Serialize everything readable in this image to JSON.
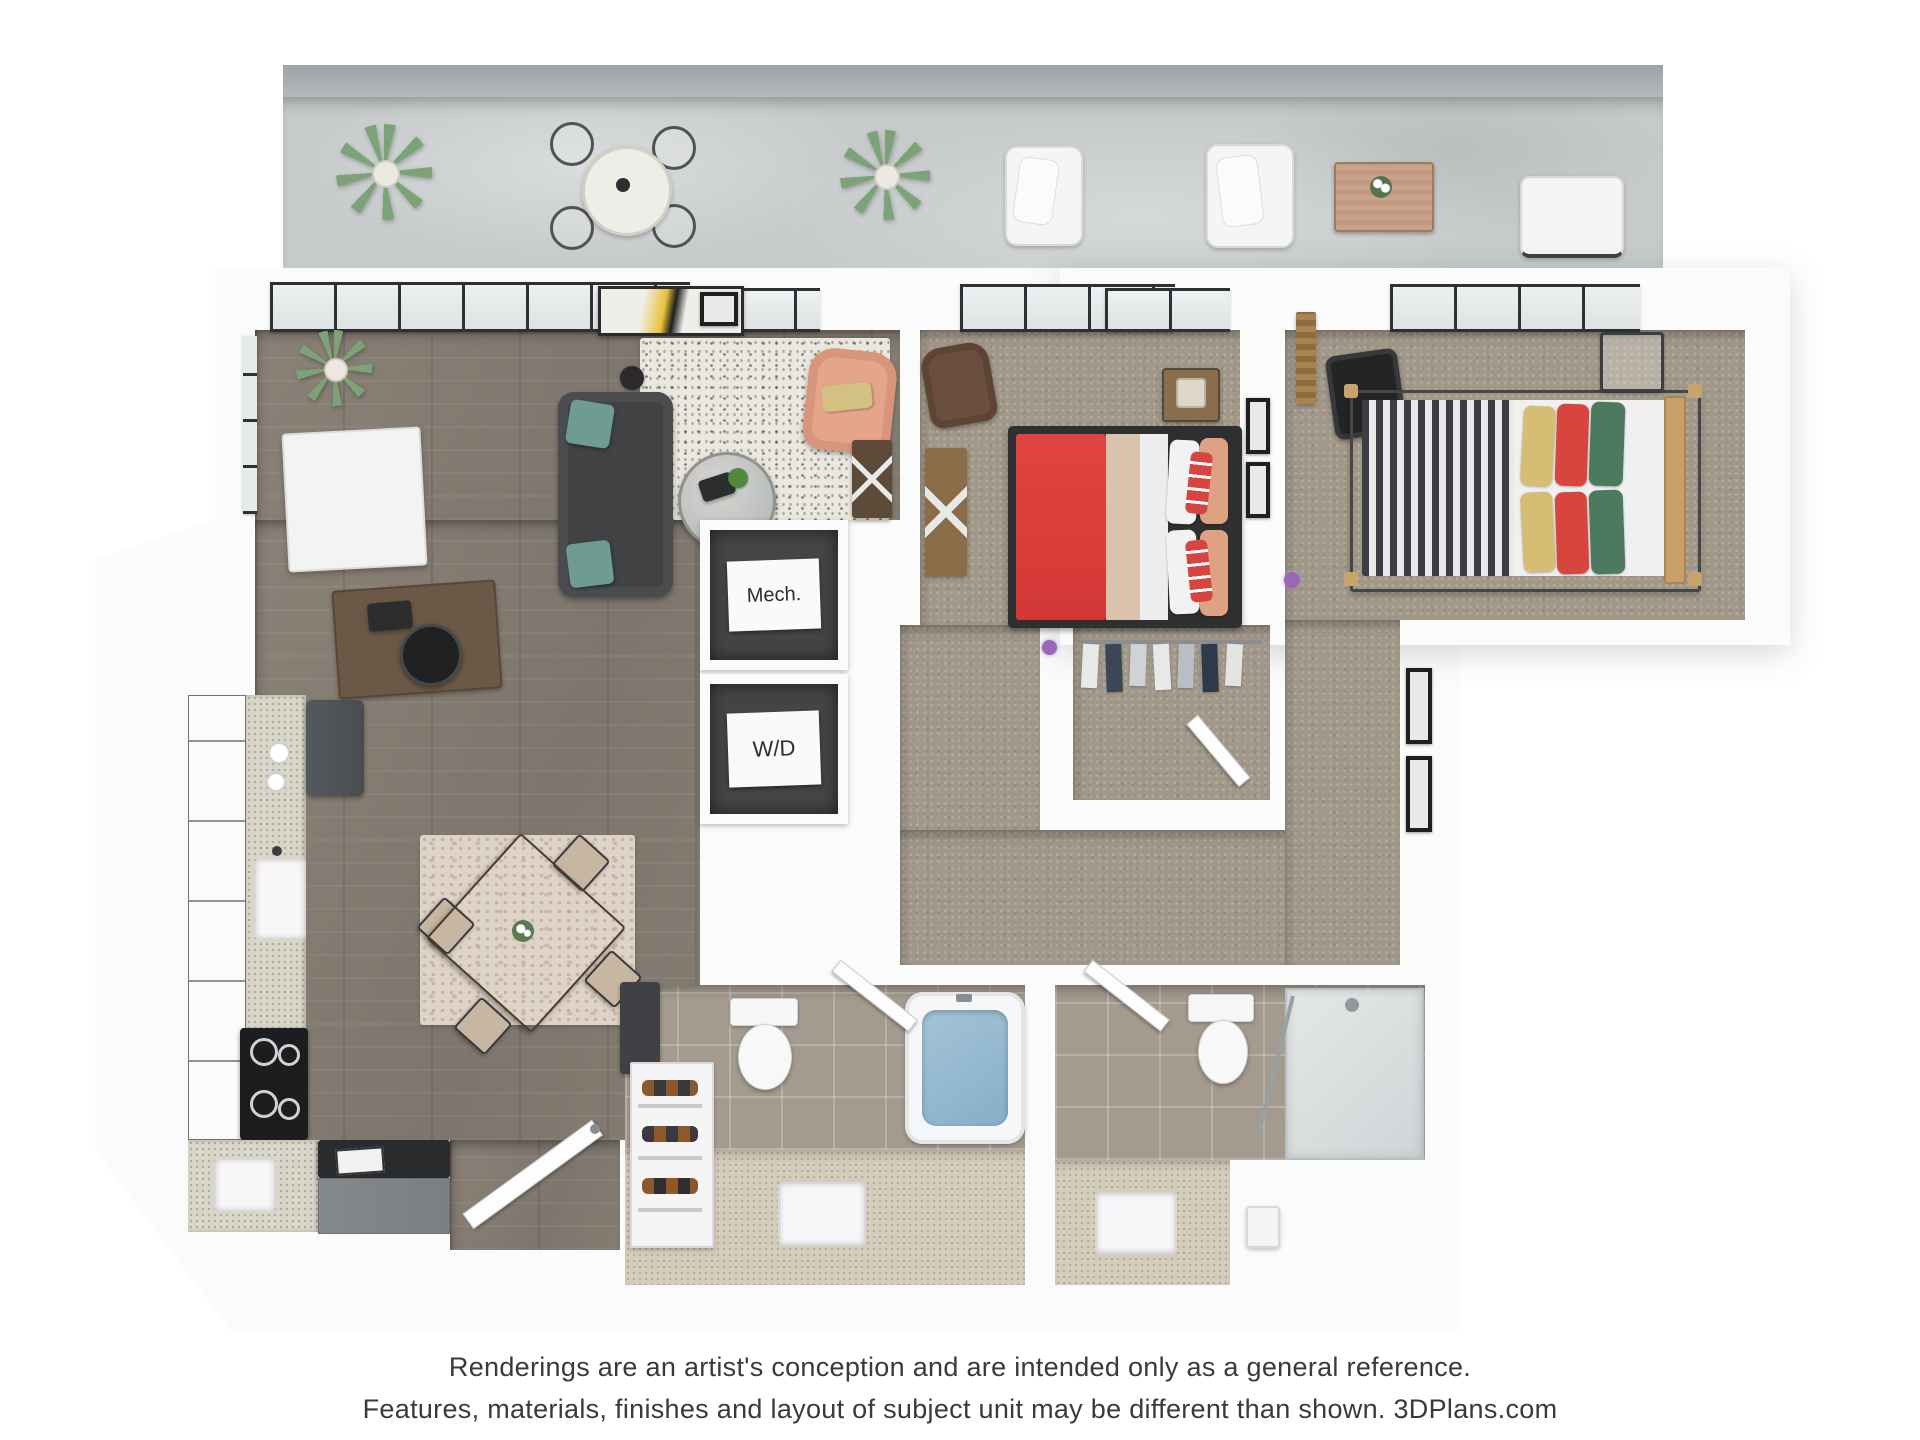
{
  "floor_plan": {
    "type": "3d-apartment-floor-plan-rendering",
    "labels": {
      "mech_closet": "Mech.",
      "washer_dryer": "W/D"
    },
    "footer": {
      "line1": "Renderings are an artist's conception and are intended only as a general reference.",
      "line2": "Features, materials, finishes and layout of subject unit may be different than shown. 3DPlans.com"
    },
    "colors": {
      "page_background": "#ffffff",
      "walls": "#fbfbfc",
      "balcony_concrete": "#c6caca",
      "hardwood_floor": "#857d72",
      "carpet": "#a19889",
      "bathroom_tile": "#a49b8e",
      "vanity_floor": "#d4cdbb",
      "sofa_gray": "#404244",
      "pillow_teal": "#6e9c92",
      "armchair_salmon": "#e4a58a",
      "bed1_blanket_red": "#dd3f3c",
      "bed2_stripe_dark": "#3b3e44",
      "bed2_pillow_yellow": "#d6bd74",
      "bed2_pillow_red": "#d8453f",
      "bed2_pillow_green": "#4c7a5e",
      "kitchen_cabinet_gray": "#7f8286",
      "tub_water_blue": "#96bcd4",
      "footer_text": "#3a3a3a"
    }
  }
}
